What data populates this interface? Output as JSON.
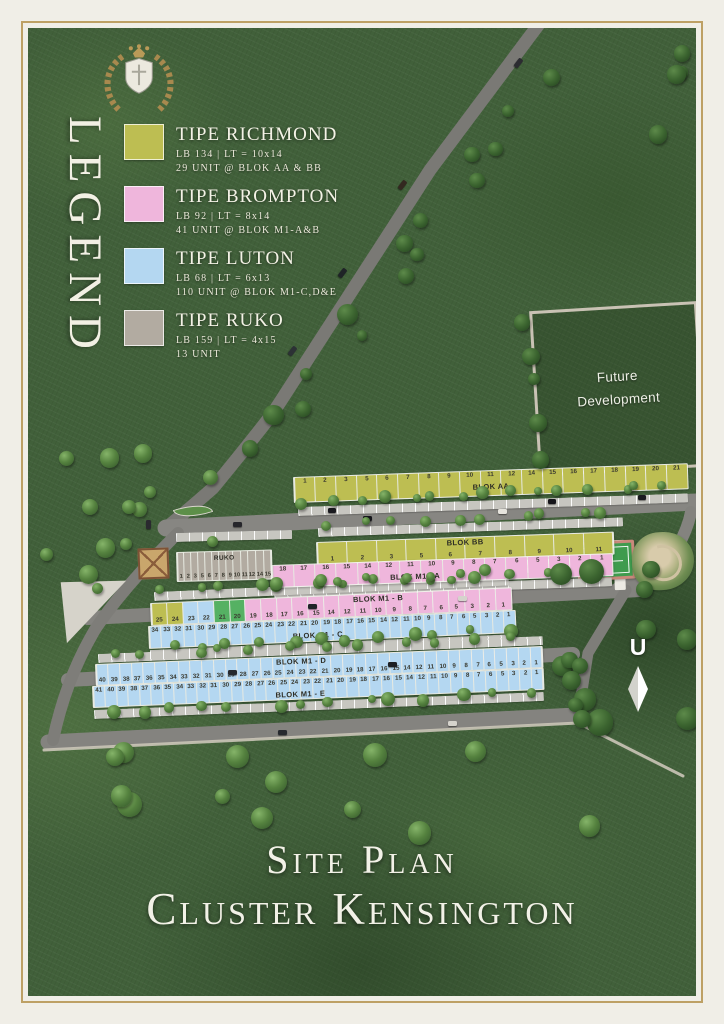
{
  "legend": {
    "title": "LEGEND",
    "colors": {
      "richmond": "#bdbe52",
      "brompton": "#efb6dc",
      "luton": "#b4d7f1",
      "ruko": "#b2aba1",
      "green": "#55b163"
    },
    "items": [
      {
        "name": "TIPE RICHMOND",
        "type": "richmond",
        "line1": "LB 134   |   LT = 10x14",
        "line2": "29 UNIT @ BLOK AA & BB"
      },
      {
        "name": "TIPE BROMPTON",
        "type": "brompton",
        "line1": "LB 92   |   LT = 8x14",
        "line2": "41 UNIT @ BLOK M1-A&B"
      },
      {
        "name": "TIPE LUTON",
        "type": "luton",
        "line1": "LB 68   |   LT = 6x13",
        "line2": "110 UNIT @ BLOK M1-C,D&E"
      },
      {
        "name": "TIPE RUKO",
        "type": "ruko",
        "line1": "LB 159   |   LT = 4x15",
        "line2": "13 UNIT"
      }
    ]
  },
  "site": {
    "future_development_line1": "Future",
    "future_development_line2": "Development",
    "north_label": "U",
    "blocks": [
      {
        "id": "aa",
        "label": "BLOK AA",
        "type": "richmond",
        "units": [
          1,
          2,
          3,
          5,
          6,
          7,
          8,
          9,
          10,
          11,
          12,
          14,
          15,
          16,
          17,
          18,
          19,
          20,
          21
        ]
      },
      {
        "id": "bb",
        "label": "BLOK BB",
        "type": "richmond",
        "units": [
          1,
          2,
          3,
          5,
          6,
          7,
          8,
          9,
          10,
          11
        ]
      },
      {
        "id": "m1a",
        "label": "BLOK M1 - A",
        "type": "brompton",
        "units": [
          18,
          17,
          16,
          15,
          14,
          12,
          11,
          10,
          9,
          8,
          7,
          6,
          5,
          3,
          2,
          1
        ]
      },
      {
        "id": "ruko",
        "label": "RUKO",
        "type": "ruko",
        "units": [
          1,
          2,
          3,
          5,
          6,
          7,
          8,
          9,
          10,
          11,
          12,
          14,
          15
        ]
      },
      {
        "id": "m1b",
        "label": "BLOK M1 - B",
        "type": "brompton",
        "units": [
          {
            "n": 25,
            "t": "richmond"
          },
          {
            "n": 24,
            "t": "richmond"
          },
          {
            "n": 23,
            "t": "luton"
          },
          {
            "n": 22,
            "t": "luton"
          },
          {
            "n": 21,
            "t": "green"
          },
          {
            "n": 20,
            "t": "green"
          },
          19,
          18,
          17,
          16,
          15,
          14,
          12,
          11,
          10,
          9,
          8,
          7,
          6,
          5,
          3,
          2,
          1
        ]
      },
      {
        "id": "m1c",
        "label": "BLOK M1 - C",
        "type": "luton",
        "units": [
          34,
          33,
          32,
          31,
          30,
          29,
          28,
          27,
          26,
          25,
          24,
          23,
          22,
          21,
          20,
          19,
          18,
          17,
          16,
          15,
          14,
          12,
          11,
          10,
          9,
          8,
          7,
          6,
          5,
          3,
          2,
          1
        ]
      },
      {
        "id": "m1d",
        "label": "BLOK M1 - D",
        "type": "luton",
        "units": [
          40,
          39,
          38,
          37,
          36,
          35,
          34,
          33,
          32,
          31,
          30,
          29,
          28,
          27,
          26,
          25,
          24,
          23,
          22,
          21,
          20,
          19,
          18,
          17,
          16,
          15,
          14,
          12,
          11,
          10,
          9,
          8,
          7,
          6,
          5,
          3,
          2,
          1
        ]
      },
      {
        "id": "m1e",
        "label": "BLOK M1 - E",
        "type": "luton",
        "units": [
          41,
          40,
          39,
          38,
          37,
          36,
          35,
          34,
          33,
          32,
          31,
          30,
          29,
          28,
          27,
          26,
          25,
          24,
          23,
          22,
          21,
          20,
          19,
          18,
          17,
          16,
          15,
          14,
          12,
          11,
          10,
          9,
          8,
          7,
          6,
          5,
          3,
          2,
          1
        ]
      }
    ]
  },
  "title": {
    "line1": "Site Plan",
    "line2": "Cluster Kensington"
  }
}
